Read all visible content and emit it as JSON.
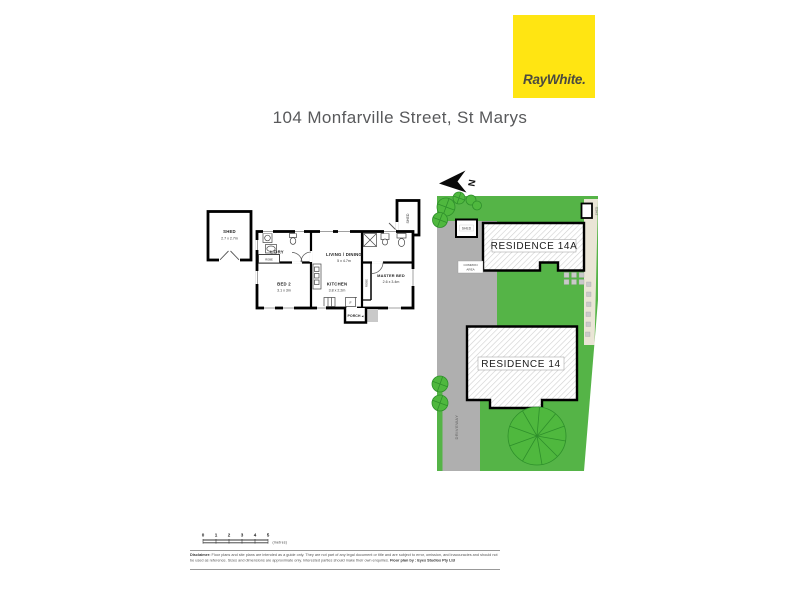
{
  "colors": {
    "brand_yellow": "#FFE512",
    "brand_text": "#4A4A40",
    "title_text": "#58595B",
    "grass": "#55B447",
    "tree_fill": "#4FB83E",
    "tree_stroke": "#2E8F2B",
    "driveway": "#AFAFAF",
    "paver_strip": "#EAE5D6",
    "wall": "#000000",
    "hatch_line": "#CFCFCF"
  },
  "header": {
    "brand": "RayWhite.",
    "title": "104 Monfarville Street, St Marys"
  },
  "floorplan": {
    "shed": {
      "name": "SHED",
      "dims": "2.7 x 2.7m"
    },
    "shed_small": {
      "name": "SHED"
    },
    "ldry": {
      "name": "L'DRY"
    },
    "robe_small": {
      "name": "ROBE"
    },
    "bed2": {
      "name": "BED 2",
      "dims": "3.1 x 3m"
    },
    "living": {
      "name": "LIVING / DINING",
      "dims": "5 x 4.7m"
    },
    "kitchen": {
      "name": "KITCHEN",
      "dims": "3.8 x 2.2m"
    },
    "master": {
      "name": "MASTER BED",
      "dims": "2.6 x 3.4m"
    },
    "robe": {
      "name": "ROBE"
    },
    "porch": {
      "name": "PORCH"
    },
    "porch_arrow": "◀",
    "fridge_label": "F"
  },
  "siteplan": {
    "north_label": "N",
    "residence_14a": "RESIDENCE 14A",
    "residence_14": "RESIDENCE 14",
    "shed_left": "SHED",
    "shed_right": "SHED",
    "common_area": [
      "COMMON",
      "AREA"
    ],
    "driveway_label": "DRIVEWAY"
  },
  "scalebar": {
    "ticks": [
      "0",
      "1",
      "2",
      "3",
      "4",
      "5"
    ],
    "unit": "(metres)"
  },
  "disclaimer": {
    "lead": "Disclaimer:",
    "body": " Floor plans and site plans are intended as a guide only. They are not part of any legal document or title and are subject to error, omission, and inaccuracies and should not be used as reference. Sizes and dimensions are approximate only. Interested parties should make their own enquiries. ",
    "credit": "Floor plan by : Eyes Studios Pty Ltd"
  }
}
